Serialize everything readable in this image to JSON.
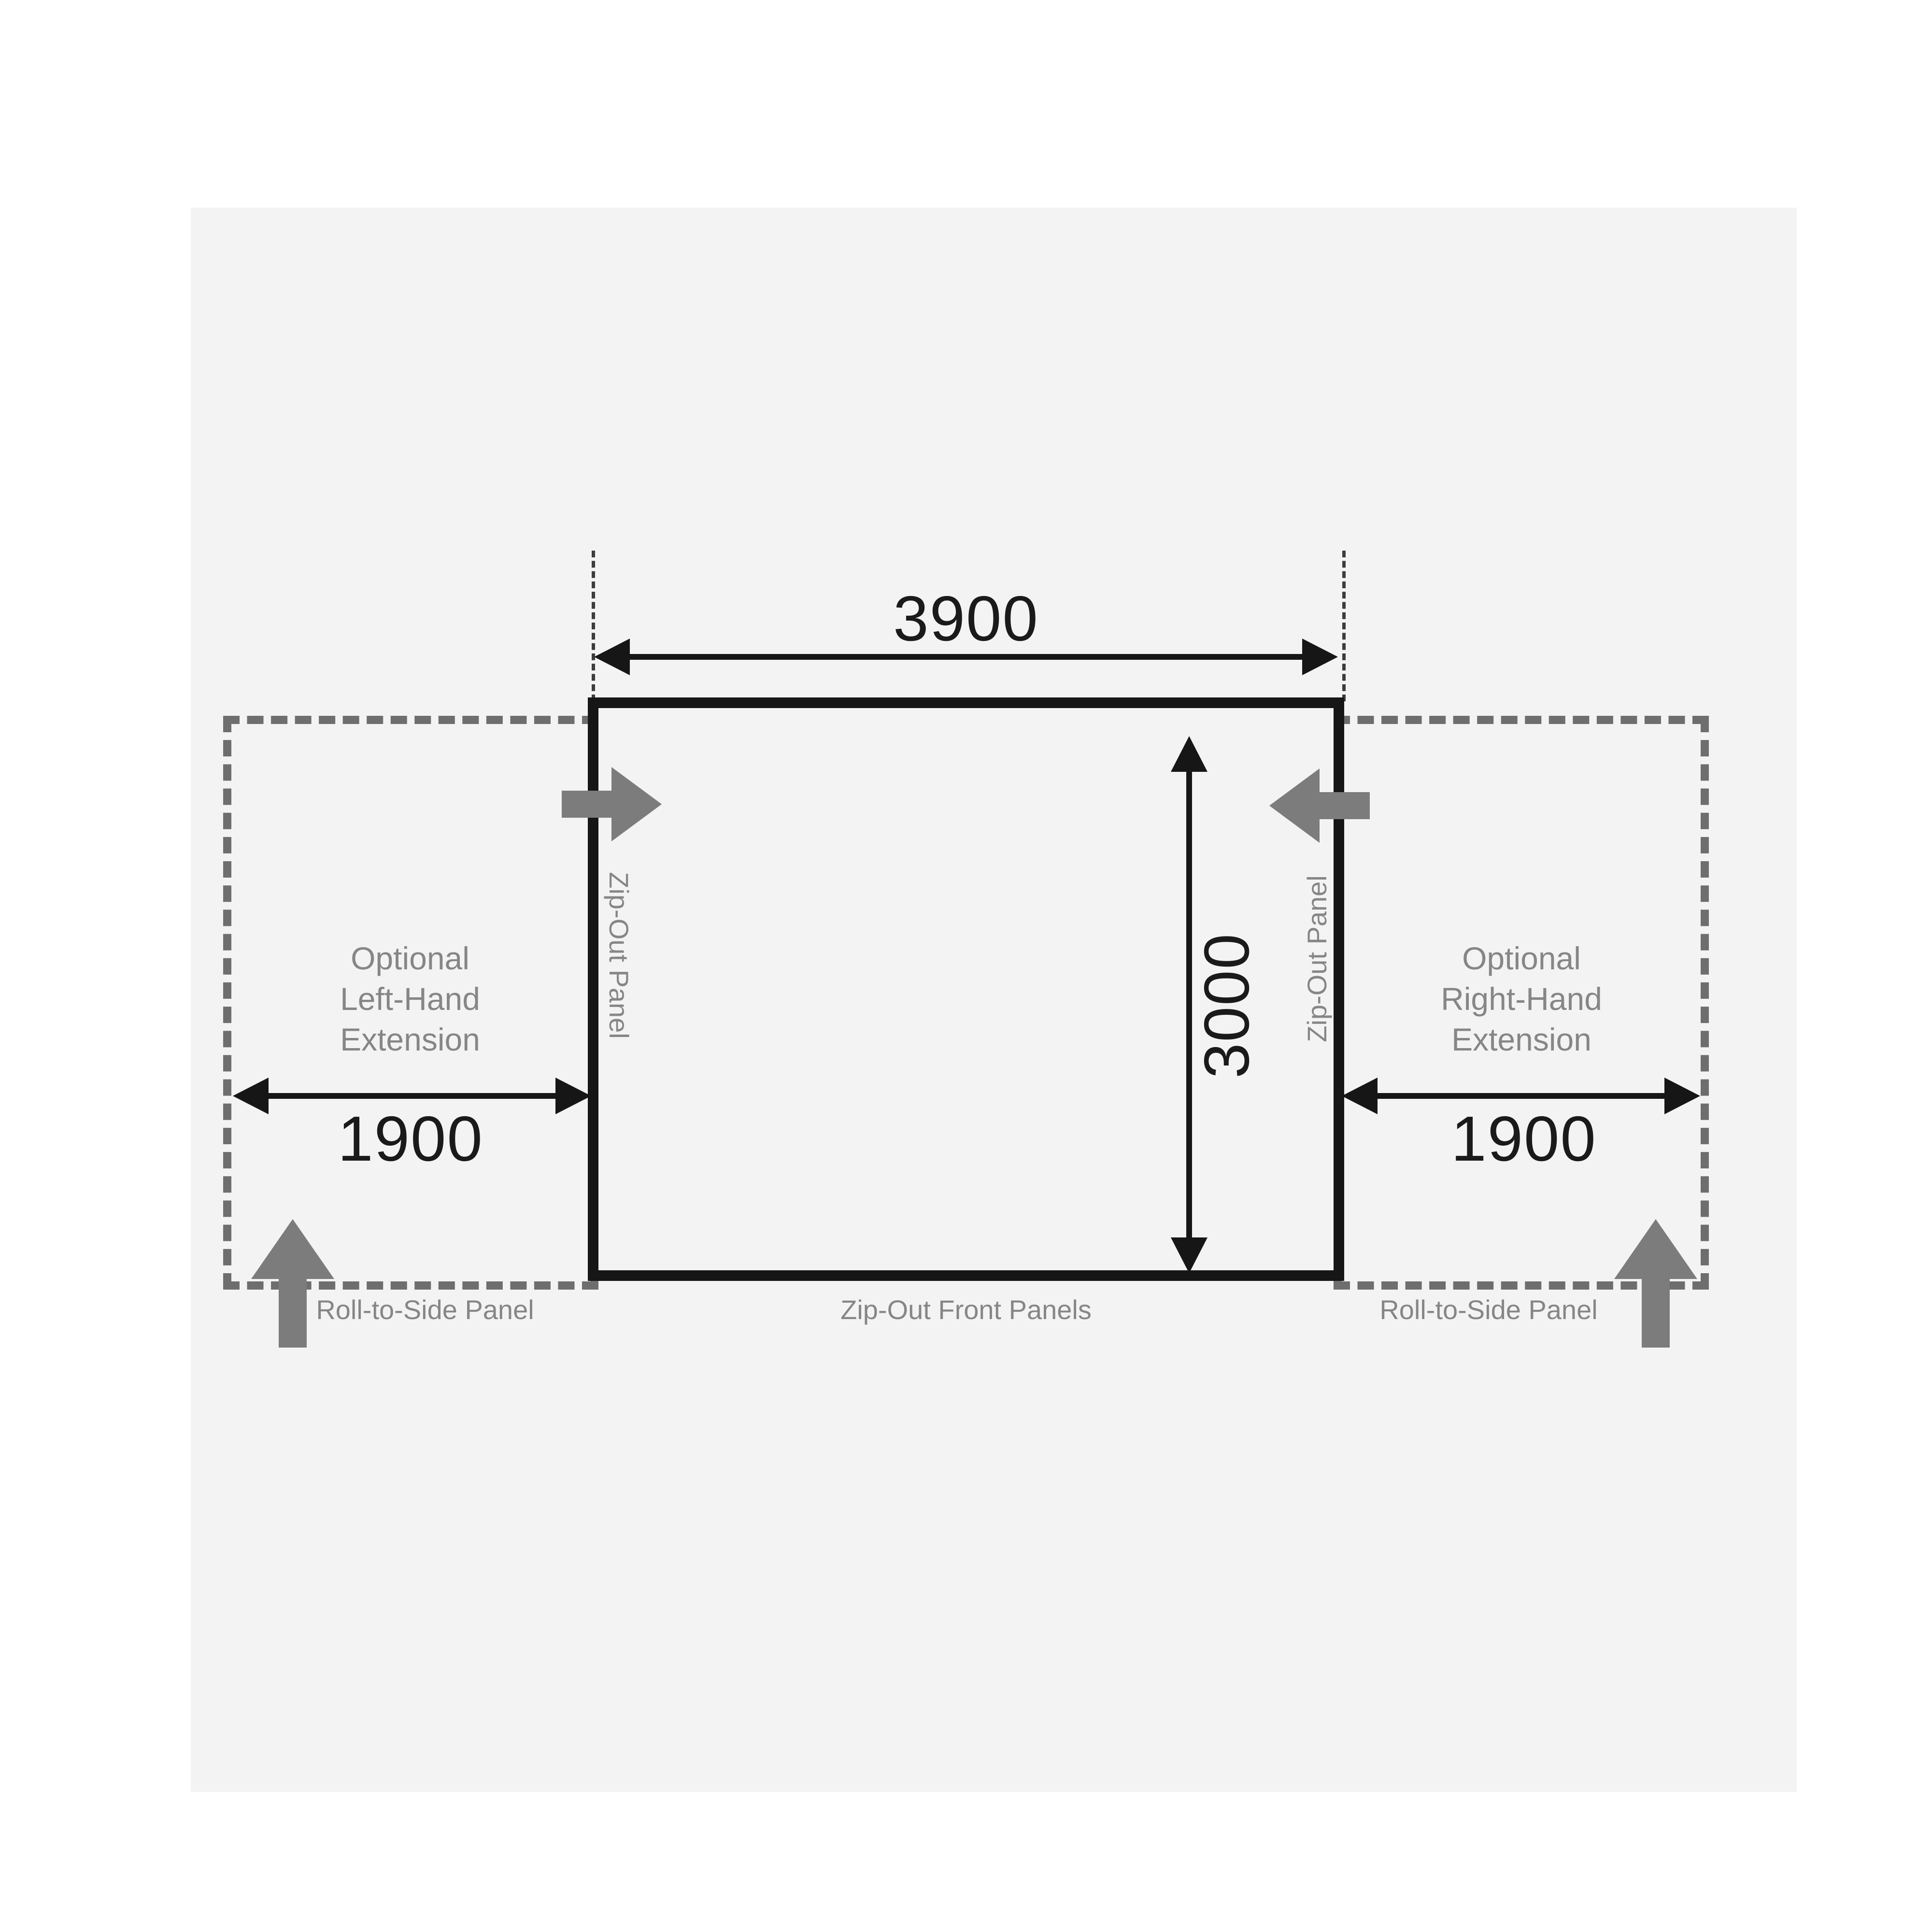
{
  "page": {
    "background_color": "#ffffff",
    "canvas_background_color": "#f3f3f4"
  },
  "colors": {
    "line_black": "#161616",
    "dimension_number": "#1a1a1a",
    "label_gray": "#868686",
    "dashed_box_gray": "#6e6e6e",
    "block_arrow_gray": "#7c7c7c"
  },
  "main_unit": {
    "width_dimension": "3900",
    "height_dimension": "3000",
    "left_panel_label": "Zip-Out Panel",
    "right_panel_label": "Zip-Out Panel",
    "front_panel_label": "Zip-Out Front Panels"
  },
  "left_extension": {
    "title": "Optional\nLeft-Hand\nExtension",
    "dimension": "1900",
    "panel_label": "Roll-to-Side Panel"
  },
  "right_extension": {
    "title": "Optional\nRight-Hand\nExtension",
    "dimension": "1900",
    "panel_label": "Roll-to-Side Panel"
  },
  "icons": {
    "top_left_arrow": "arrow-right-icon",
    "top_right_arrow": "arrow-left-icon",
    "bottom_left_arrow": "arrow-up-icon",
    "bottom_right_arrow": "arrow-up-icon"
  }
}
